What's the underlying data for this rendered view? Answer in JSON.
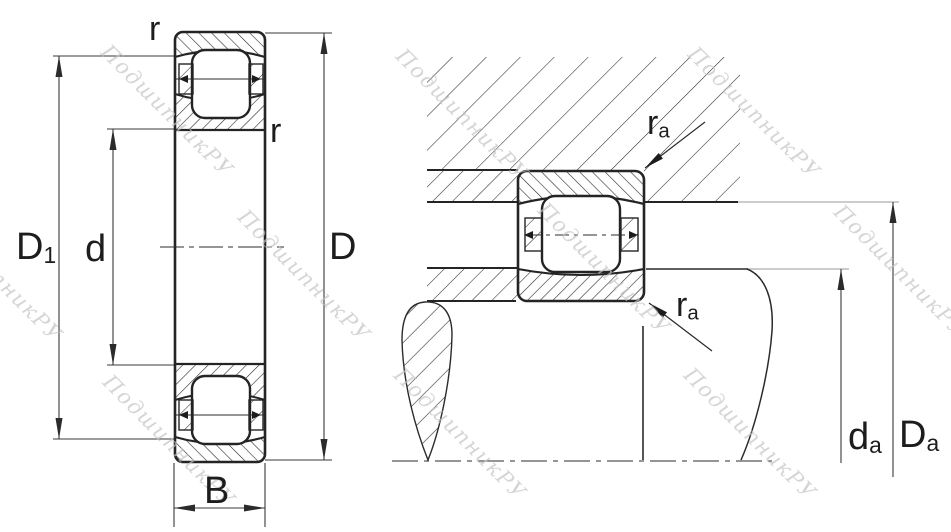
{
  "watermark": {
    "text": "ПодшипникРУ"
  },
  "left_view": {
    "labels": {
      "r_top": {
        "main": "r",
        "sub": ""
      },
      "r_inner": {
        "main": "r",
        "sub": ""
      },
      "D1": {
        "main": "D",
        "sub": "1"
      },
      "d": {
        "main": "d",
        "sub": ""
      },
      "D": {
        "main": "D",
        "sub": ""
      },
      "B": {
        "main": "B",
        "sub": ""
      }
    }
  },
  "right_view": {
    "labels": {
      "ra_top": {
        "main": "r",
        "sub": "a"
      },
      "ra_bottom": {
        "main": "r",
        "sub": "a"
      },
      "da": {
        "main": "d",
        "sub": "a"
      },
      "Da": {
        "main": "D",
        "sub": "a"
      }
    }
  },
  "colors": {
    "line": "#2b2b2b",
    "dimension_line": "#3a3a3a",
    "extension_gray": "#9a9a9a",
    "watermark": "#c2c2c2",
    "background": "#ffffff"
  }
}
